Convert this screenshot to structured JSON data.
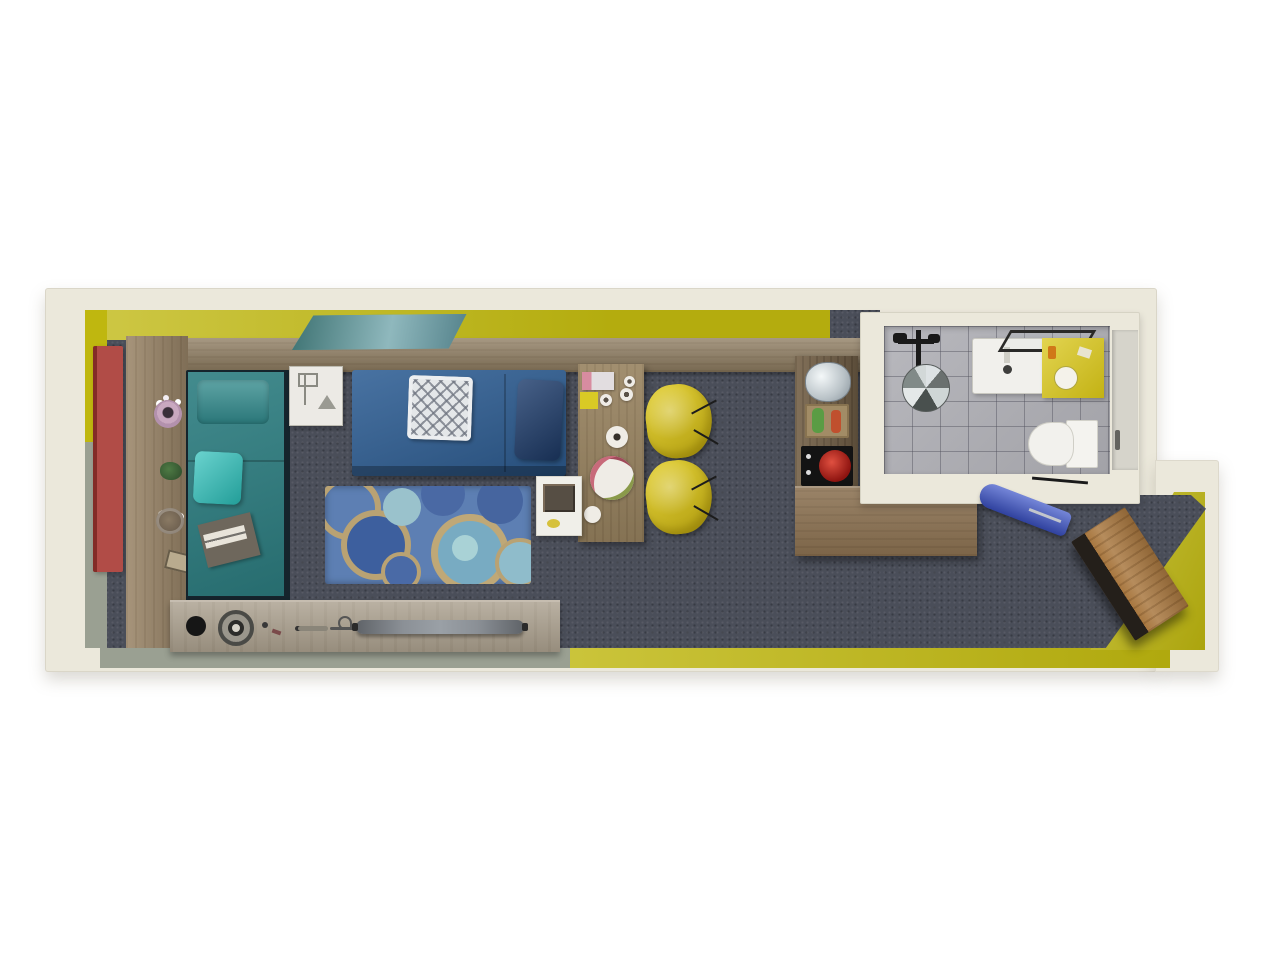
{
  "scene": {
    "title": "3D top-down floor plan of a narrow studio apartment",
    "view": "top-down axonometric render",
    "rooms": {
      "main_room": {
        "label": "Living and sleeping area",
        "floor": "dark gray carpet"
      },
      "bathroom": {
        "label": "Bathroom",
        "floor": "gray ceramic tile"
      },
      "entry": {
        "label": "Entry corridor",
        "floor": "dark gray carpet"
      }
    },
    "furniture": {
      "red_door": {
        "label": "Red entry door panel"
      },
      "wall_shelf": {
        "label": "Wood display shelf with flower pot, plant, bowl and frame"
      },
      "bed": {
        "label": "Teal single bed with pillow, turquoise cushion and tray"
      },
      "nightstand": {
        "label": "White sketch-style nightstand cube"
      },
      "sofa": {
        "label": "Blue daybed sofa with lattice cushion and navy pillow"
      },
      "rug": {
        "label": "Blue circle-pattern area rug"
      },
      "desk": {
        "label": "Wood dining desk with plates, food plate and mug"
      },
      "side_table": {
        "label": "White side table with bottle tray"
      },
      "chair_1": {
        "label": "Yellow shell chair"
      },
      "chair_2": {
        "label": "Yellow shell chair"
      },
      "kitchen_shelf": {
        "label": "Kitchenette unit with kettle, cutting board and bottles"
      },
      "cooktop": {
        "label": "Black two-burner cooktop with red kettle"
      },
      "counter": {
        "label": "L-shaped wood kitchen counter"
      },
      "wall_art": {
        "label": "Teal landscape artwork on yellow wall"
      },
      "console": {
        "label": "Low media console with speakers and skateboard"
      },
      "shower": {
        "label": "Overhead shower fixture"
      },
      "sink": {
        "label": "White washbasin vanity"
      },
      "bath_counter": {
        "label": "Yellow bathroom counter with round basin"
      },
      "toilet": {
        "label": "White toilet"
      },
      "ironing_board": {
        "label": "Blue fold-down ironing board"
      },
      "bench": {
        "label": "Angled wood entry bench"
      }
    }
  },
  "palette": {
    "background": "#ffffff",
    "wall_outer": "#ebe8db",
    "accent_yellow": "#bfb70f",
    "wall_sage": "#9aa092",
    "carpet": "#4a4e59",
    "tile_gray": "#b0b0b6",
    "wood_ledge": "#8e7c60",
    "wood_shelf": "#9b8669",
    "wood_desk": "#97825f",
    "wood_kitchen": "#77644b",
    "wood_counter": "#8a7050",
    "wood_console": "#a89d8b",
    "wood_bench": "#a97840",
    "bed_teal": "#2d7e81",
    "bed_pillow": "#318a8c",
    "cushion_turquoise": "#2ac0ba",
    "sofa_blue": "#2f5f95",
    "sofa_pillow_navy": "#1f3e6e",
    "rug_base": "#5d7fb3",
    "chair_yellow": "#e0ca18",
    "door_red": "#a83832",
    "counter_yellow": "#d9c616",
    "ironing_blue": "#3f57c9",
    "art_teal": "#5d9a99"
  }
}
